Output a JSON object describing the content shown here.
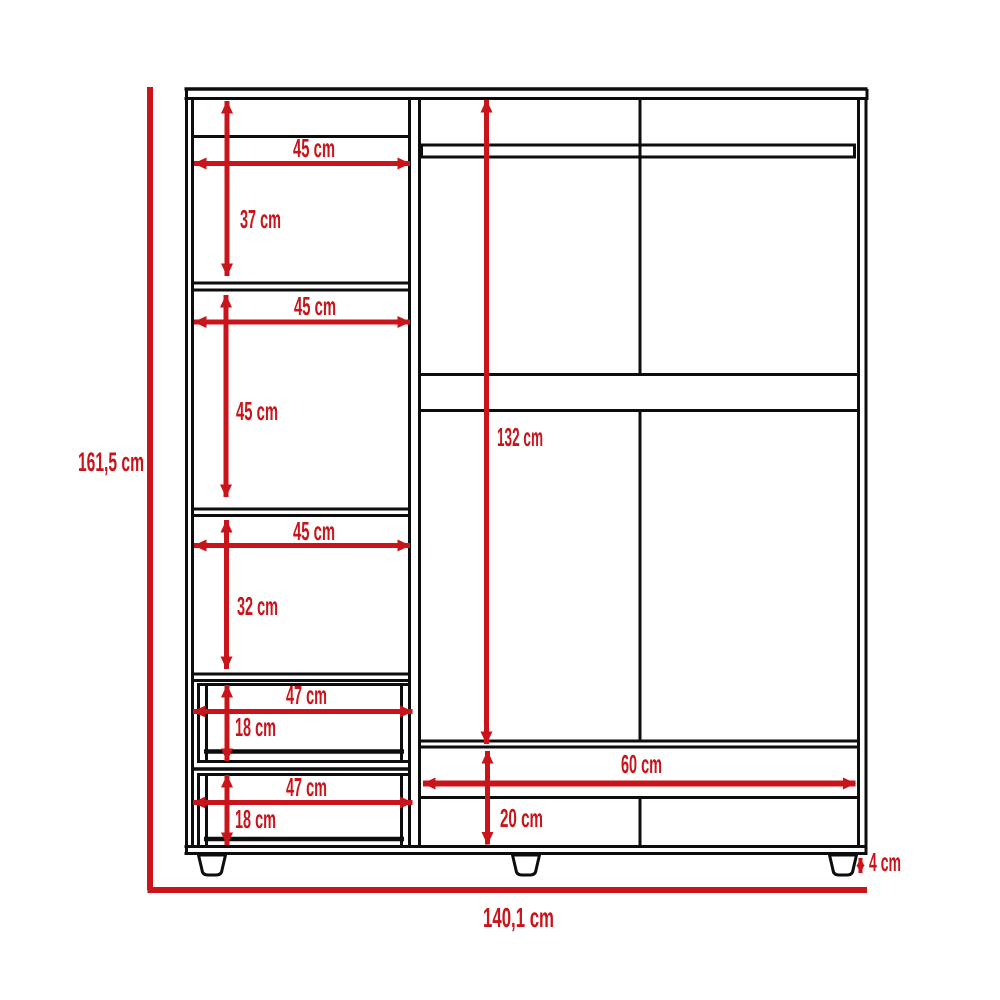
{
  "diagram": {
    "type": "furniture-dimension-drawing",
    "subject": "wardrobe front elevation with shelves, drawers and hanging section",
    "units": "cm",
    "accent_color": "#c8141a",
    "line_color": "#0d0d0d",
    "overall": {
      "height": "161,5 cm",
      "width": "140,1 cm",
      "leg_height": "4 cm"
    },
    "left_column": {
      "shelves": [
        {
          "width": "45 cm",
          "height": "37 cm"
        },
        {
          "width": "45 cm",
          "height": "45 cm"
        },
        {
          "width": "45 cm",
          "height": "32 cm"
        }
      ],
      "drawers": [
        {
          "width": "47 cm",
          "height": "18 cm"
        },
        {
          "width": "47 cm",
          "height": "18 cm"
        }
      ]
    },
    "right_section": {
      "height": "132 cm",
      "bottom": {
        "width": "60 cm",
        "height": "20 cm"
      }
    }
  }
}
